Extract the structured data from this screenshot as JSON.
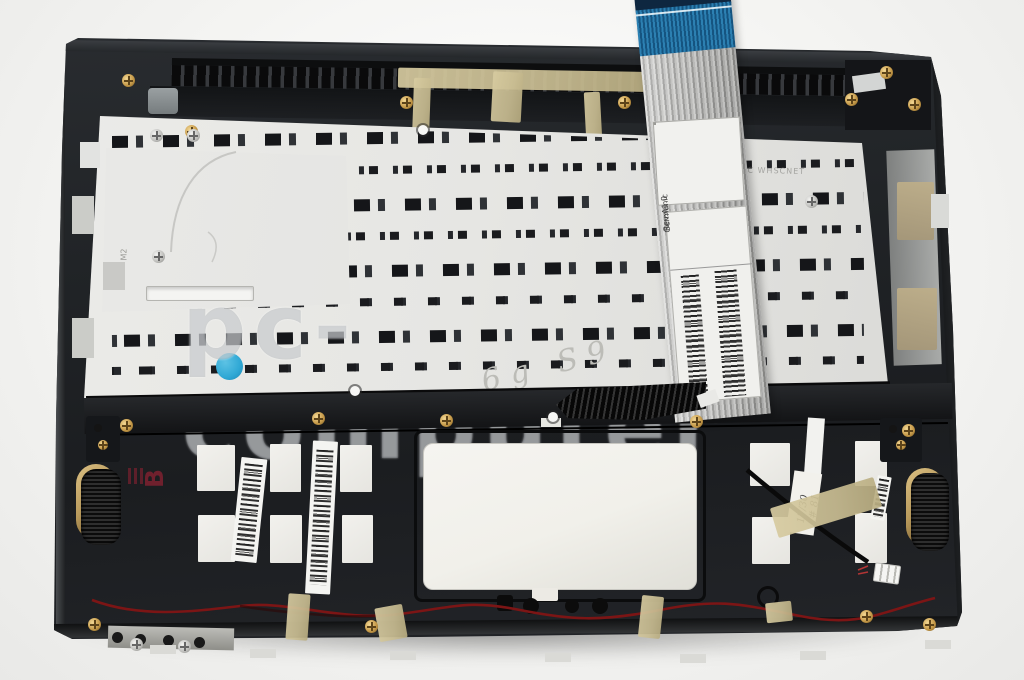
{
  "photo": {
    "watermark": "pc-computer",
    "subject": "Laptop palmrest top case with keyboard backplate, flex cable, speakers and touchpad (internal rear view)"
  },
  "ribbon_cable": {
    "grid_label": {
      "column_texts": [
        "FA!",
        "MAY",
        "KT"
      ],
      "bottom_row": [
        "V",
        "F",
        "R"
      ]
    },
    "rev_label": {
      "line1": "Rev:A1.0",
      "line2": "Germanic"
    }
  },
  "markings": {
    "handwritten_plate": "6g S9",
    "handwritten_tag": [
      "17/30",
      "1# 81"
    ],
    "stamp": "B",
    "etched_plate": "LNURC WHSCNET",
    "etched_corner": "M2"
  },
  "colors": {
    "chassis": "#1e2124",
    "plate": "#e7e7e4",
    "cableBlue": "#1d6fa5",
    "tape": "#c9bd92",
    "wireRed": "#7c1515",
    "speakerGold": "#b99a5c",
    "touchpad": "#f1f0ea",
    "blueDot": "#2fa8d5",
    "stampRed": "#7e2130",
    "watermarkGray": "#9aa0a4"
  }
}
